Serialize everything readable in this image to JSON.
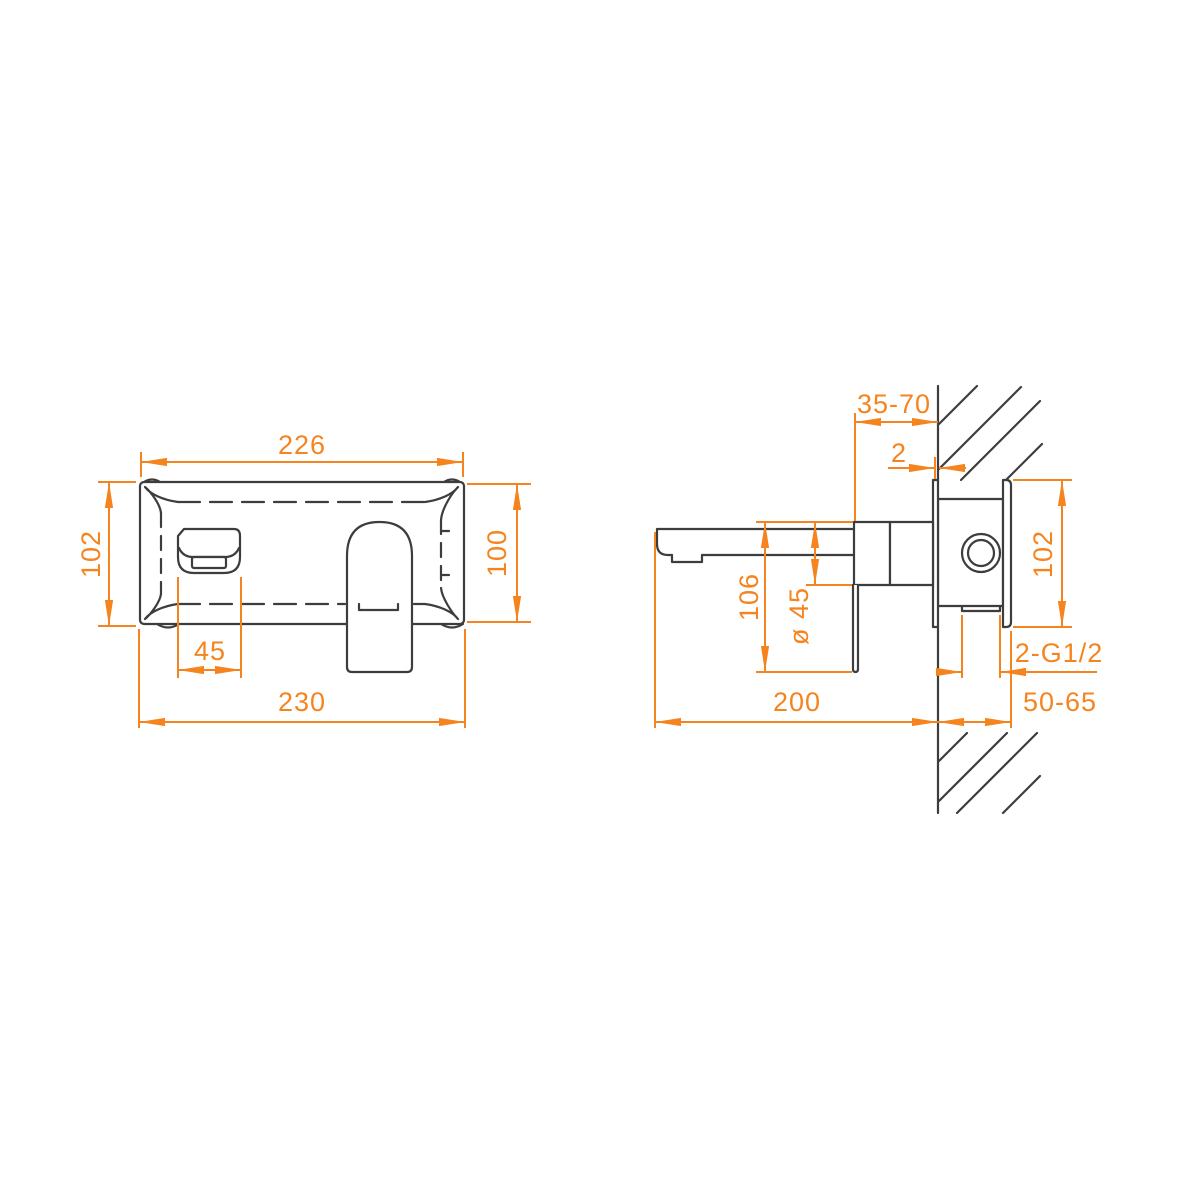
{
  "drawing": {
    "kind": "technical-dimension-drawing",
    "subject": "wall-mounted basin mixer (concealed single-lever faucet), front view and side section at wall",
    "units": "mm",
    "colors": {
      "dimension_accent": "#f5841e",
      "outline": "#3d3d3d",
      "background": "#ffffff"
    },
    "front_view": {
      "dimensions": {
        "plate_width_top": "226",
        "height_left": "102",
        "height_right": "100",
        "spout_width": "45",
        "overall_width_bottom": "230"
      }
    },
    "side_view": {
      "dimensions": {
        "wall_to_face_range": "35-70",
        "trim_plate_gap": "2",
        "inwall_body_height": "102",
        "spout_to_handle_drop": "106",
        "handle_base_diameter": "ø 45",
        "thread_connections": "2-G1/2",
        "spout_reach": "200",
        "embed_depth_range": "50-65"
      }
    }
  }
}
